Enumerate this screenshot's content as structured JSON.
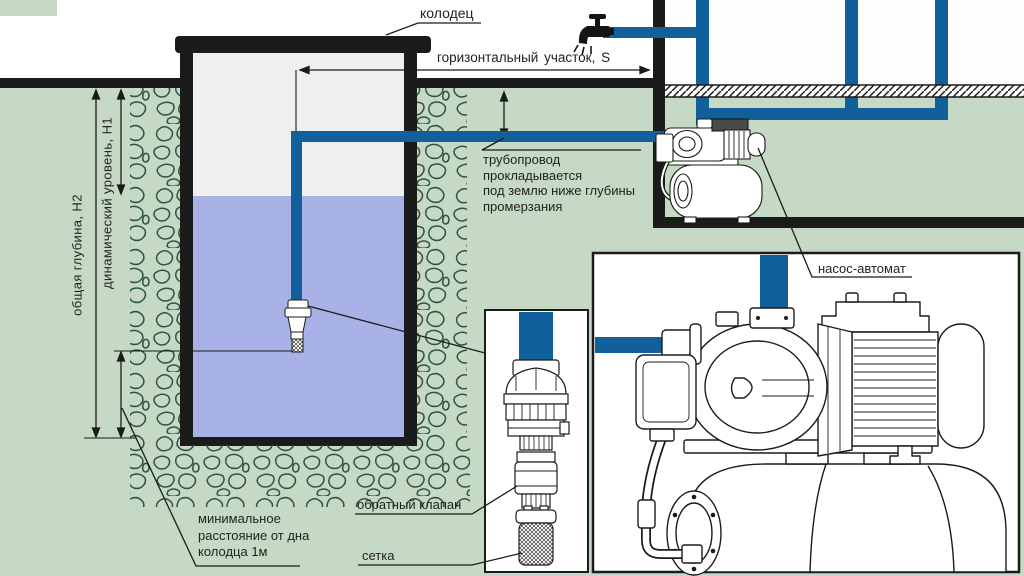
{
  "colors": {
    "background_green": "#c6d9c5",
    "water_blue": "#a9b2e7",
    "pipe_blue": "#11609c",
    "well_interior_gray": "#efefef",
    "line_black": "#1b1b1b",
    "sky_white": "#ffffff",
    "stone_outline_green": "#2e5348"
  },
  "labels": {
    "well": "колодец",
    "horizontal_section": "горизонтальный участок, S",
    "freeze_note": "трубопровод\nпрокладывается\nпод землю ниже глубины\nпромерзания",
    "pump_station": "насос-автомат",
    "check_valve": "обратный клапан",
    "strainer": "сетка",
    "min_distance": "минимальное\nрасстояние от дна\nколодца 1м",
    "total_depth": "общая глубина, Н2",
    "dynamic_level": "динамический уровень, Н1"
  }
}
